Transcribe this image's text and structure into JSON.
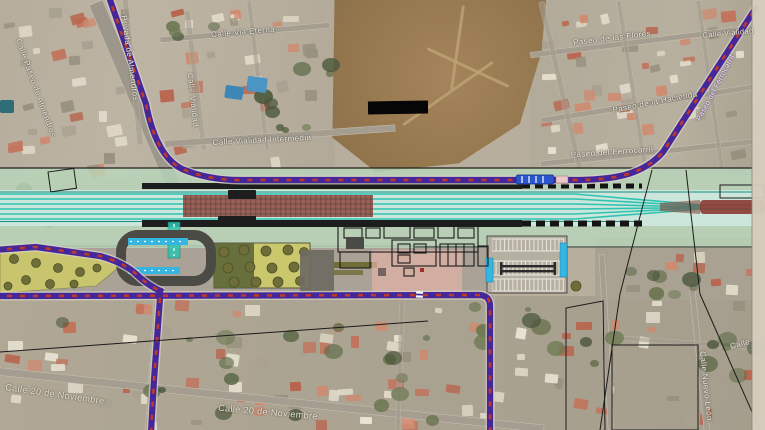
{
  "map": {
    "kind_label": "aerial plan view of railway station project overlaid on satellite imagery"
  },
  "overlay_colors": {
    "route_purple": "#45279a",
    "route_dash_red": "#bf3a2a",
    "route_casing": "#d8d2c6",
    "track_teal": "#2ec4b2",
    "track_teal_dark": "#188f85",
    "corridor_mint": "#b8d7bc",
    "track_bed": "#cfe9df",
    "works_red": "#8a3a32",
    "platform_dark": "#1d1d1d",
    "bus_bay_blue": "#35b6e0",
    "bus_vehicle_blue": "#2a55cc",
    "plaza_pink": "#e2b2a6",
    "lawn_green": "#cbc76d",
    "tree_olive": "#6f6d38",
    "tree_dark": "#4a5226",
    "parking_pad": "#b6b0a2",
    "road_dark": "#4c4a45",
    "crossing_white": "#ffffff",
    "margin_cream": "#d6cdbe",
    "redaction_black": "#060606"
  },
  "street_labels": [
    {
      "text": "Calle Paseo de Almendros",
      "x": 36,
      "y": 88,
      "rot": 70,
      "size": 8,
      "tone": "light"
    },
    {
      "text": "Privada de Almendros",
      "x": 130,
      "y": 58,
      "rot": 82,
      "size": 8,
      "tone": "light"
    },
    {
      "text": "Calle Vialidad",
      "x": 193,
      "y": 100,
      "rot": 84,
      "size": 8,
      "tone": "light"
    },
    {
      "text": "Calle Via Eterna",
      "x": 243,
      "y": 32,
      "rot": -5,
      "size": 8,
      "tone": "light"
    },
    {
      "text": "Calle Vialidad Intermedia",
      "x": 262,
      "y": 140,
      "rot": -3,
      "size": 8,
      "tone": "light"
    },
    {
      "text": "Paseo de las Flores",
      "x": 612,
      "y": 38,
      "rot": -7,
      "size": 8,
      "tone": "light"
    },
    {
      "text": "Paseo de la Hacienda",
      "x": 655,
      "y": 102,
      "rot": -11,
      "size": 8,
      "tone": "light"
    },
    {
      "text": "Paseo del Ferrocarril",
      "x": 612,
      "y": 152,
      "rot": -4,
      "size": 8,
      "tone": "light"
    },
    {
      "text": "Paseo del Ferrocarril",
      "x": 716,
      "y": 88,
      "rot": -62,
      "size": 7,
      "tone": "onroute"
    },
    {
      "text": "Calle Vialidad",
      "x": 728,
      "y": 33,
      "rot": -5,
      "size": 7.5,
      "tone": "light"
    },
    {
      "text": "Calle 20 de Noviembre",
      "x": 55,
      "y": 394,
      "rot": 8,
      "size": 9,
      "tone": "dark"
    },
    {
      "text": "Calle 20 de Noviembre",
      "x": 268,
      "y": 412,
      "rot": 5,
      "size": 9,
      "tone": "dark"
    },
    {
      "text": "Calle Nuevo León",
      "x": 706,
      "y": 386,
      "rot": 84,
      "size": 8,
      "tone": "light"
    },
    {
      "text": "Calle",
      "x": 740,
      "y": 344,
      "rot": -15,
      "size": 8,
      "tone": "light"
    }
  ]
}
